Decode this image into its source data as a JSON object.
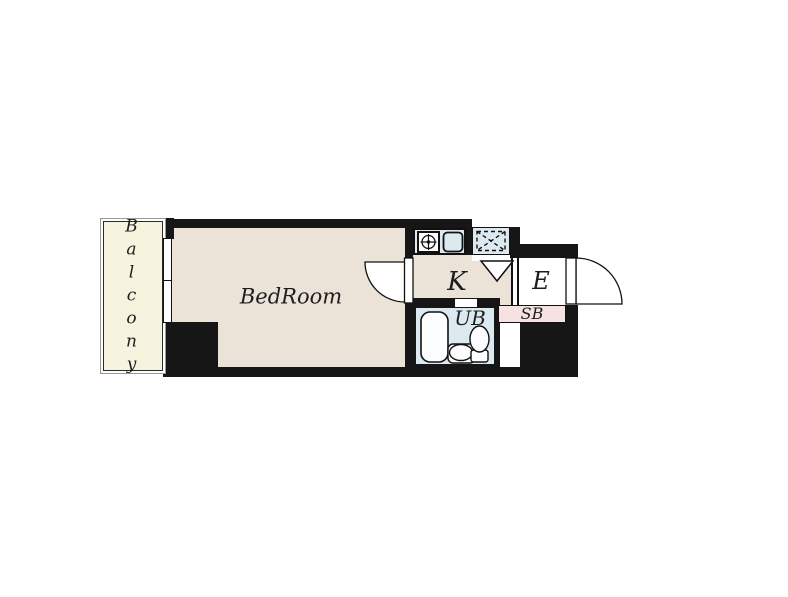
{
  "title": "Apartment floor plan",
  "labels": {
    "balcony": "Balcony",
    "bedroom": "BedRoom",
    "kitchen": "K",
    "entrance": "E",
    "unit_bath": "UB",
    "shoe_box": "SB"
  },
  "colors": {
    "background": "#ffffff",
    "wall": "#161616",
    "floor": "#ece3d8",
    "balcony": "#f6f4df",
    "wet-area": "#dde9f0",
    "shoe-box": "#f6e3e1",
    "line": "#111111"
  },
  "icons": {
    "stove": "gas-stove-icon",
    "kitchen_sink": "kitchen-sink-icon",
    "refrigerator_space": "refrigerator-space-icon",
    "triangle_marker": "triangle-marker-icon",
    "bathtub": "bathtub-icon",
    "washbasin": "washbasin-icon",
    "toilet": "toilet-icon",
    "window": "window-icon",
    "room_door": "room-door-swing-icon",
    "entrance_door": "entrance-door-swing-icon"
  }
}
